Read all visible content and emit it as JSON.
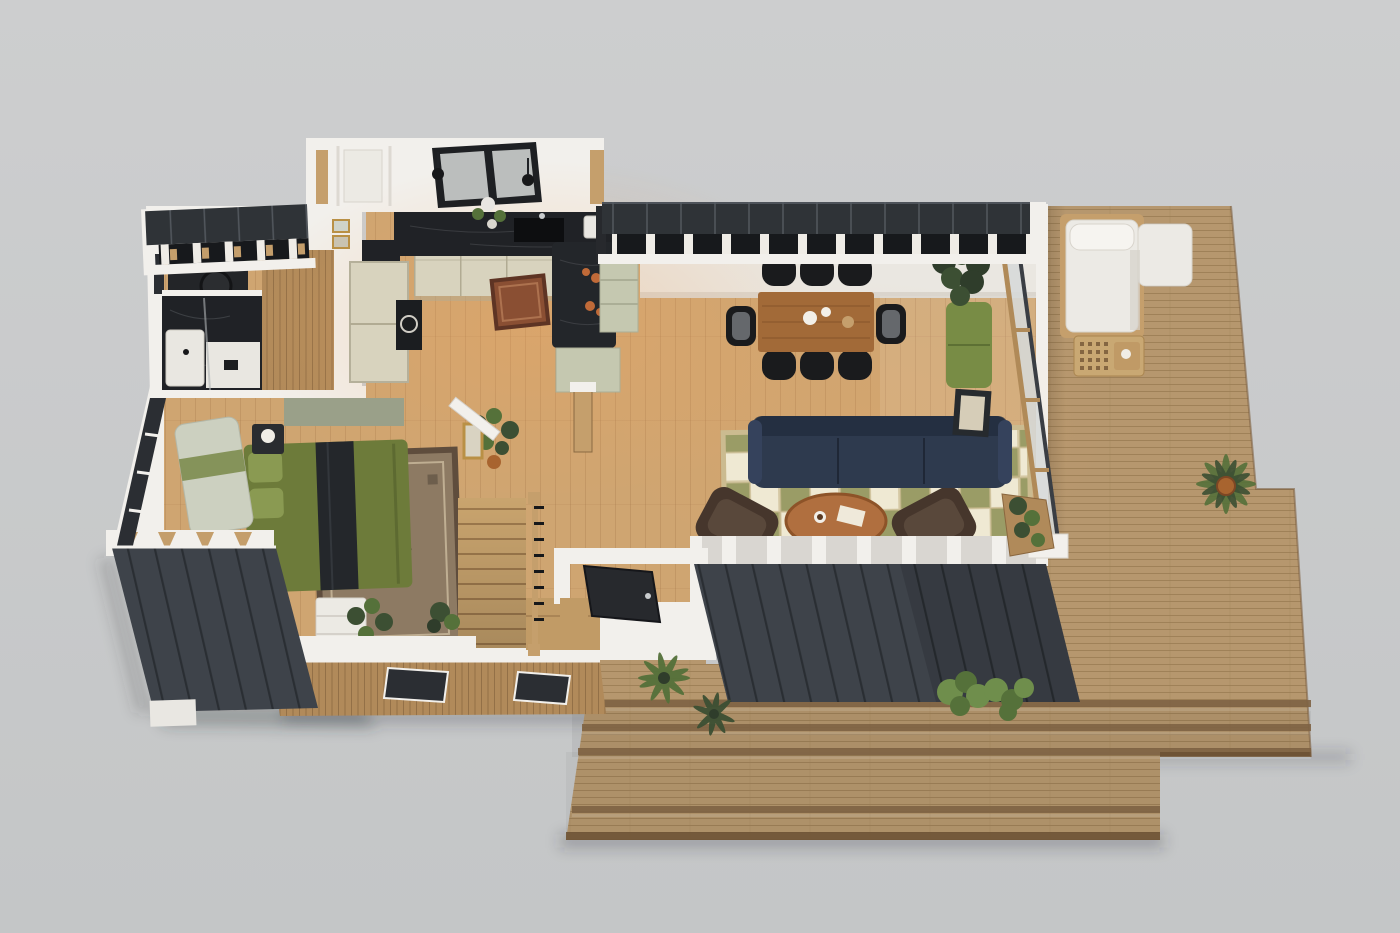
{
  "colors": {
    "background": "#cdcecf",
    "background_bottom": "#c4c6c7",
    "wall_white": "#f2f0ec",
    "wall_face": "#eae7e1",
    "wall_shade": "#cfc9c0",
    "roof_black": "#2f3337",
    "roof_seam": "#565c63",
    "rafter_dark": "#17191c",
    "joist_white": "#efece6",
    "rafter_wood": "#c49e6b",
    "panel_dark": "#3e434a",
    "panel_seam": "#272b30",
    "deck_wood": "#b6976e",
    "deck_line": "#9b7c54",
    "step_face": "#7e6344",
    "step_edge": "#6e5336",
    "floor_wood": "#cfa571",
    "floor_line": "#8a5f36",
    "floor_glow": "#f2a45e",
    "slat_wood": "#b18a5a",
    "slat_line": "#8a673f",
    "marble_dark": "#202226",
    "marble_vein": "#585c60",
    "cabinet_cream": "#d8d3be",
    "cabinet_line": "#b1ab93",
    "cabinet_sage": "#c5c8b0",
    "island_dark": "#23262a",
    "stair_wood": "#c9a46e",
    "stair_line": "#8f6b42",
    "rug_red": "#8a4f33",
    "rug_red_border": "#5e3424",
    "rug_checker_olive": "#9a9c66",
    "rug_checker_cream": "#efe9d3",
    "rug_checker_line": "#cbbb90",
    "sofa_navy": "#2e3a4e",
    "sofa_navy_dark": "#222d3f",
    "armchair_brown": "#46362c",
    "armchair_light": "#5d4b3e",
    "table_wood": "#a26a38",
    "table_wood_dark": "#7c4e26",
    "coffee_table": "#b06f3f",
    "chair_black": "#1a1b1d",
    "chair_pad": "#65686c",
    "sofa_green": "#788c45",
    "bed_green": "#6d7b3a",
    "bed_green_light": "#8a9a52",
    "throw_dark": "#24272b",
    "bench_light": "#ccd0c0",
    "throw_green": "#7d8c4f",
    "rug_bed_field": "#8d7a63",
    "rug_bed_border": "#5f4d3d",
    "rug_bed_motif": "#4e4136",
    "rug_bed_line": "#bfae92",
    "daybed_white": "#eceae5",
    "daybed_shadow": "#d6d2ca",
    "frame_tan": "#c59f6c",
    "lattice": "#c9a873",
    "lattice_hole": "#7d5f3d",
    "plant_deep": "#2f3d2b",
    "plant_dark": "#3c4f33",
    "plant_mid": "#55713a",
    "plant_light": "#6f8e4c",
    "pot_terracotta": "#a8642f",
    "glass_light": "#d6d9d8",
    "glass_frame": "#b08a58",
    "track_dark": "#3a3e44",
    "door_dark": "#27292d",
    "window_dark": "#2b2e33",
    "mirror_frame": "#262a2e",
    "mirror_glass": "#d6cdb8",
    "art_frame": "#b99045",
    "art_scene": "#9aa089",
    "dresser_white": "#eceae4",
    "lamp_white": "#f0ede6"
  },
  "scene": {
    "type": "3d-floor-plan-render",
    "view": "cutaway-top-down-isometric",
    "areas": [
      {
        "name": "entry-office",
        "objects": [
          "desk",
          "desk-chair",
          "potted-plant"
        ]
      },
      {
        "name": "bathroom",
        "objects": [
          "marble-shower",
          "shower-tray",
          "glass-divider",
          "vanity"
        ]
      },
      {
        "name": "hallway-closet",
        "objects": [
          "framed-art",
          "framed-art"
        ]
      },
      {
        "name": "kitchen",
        "objects": [
          "marble-counter",
          "cream-cabinets",
          "tall-pantry-cabinets",
          "range-oven",
          "kitchen-island",
          "sink",
          "window",
          "pendant-lights",
          "runner-rug",
          "toaster",
          "flower-vase",
          "fruit-bowls",
          "island-plant",
          "sage-cabinet"
        ]
      },
      {
        "name": "dining-area",
        "objects": [
          "wood-dining-table",
          "black-dining-chairs-x8",
          "tableware"
        ]
      },
      {
        "name": "living-area",
        "objects": [
          "navy-sofa",
          "checkered-rug",
          "oval-coffee-table",
          "leather-armchair-left",
          "leather-armchair-right",
          "green-bench",
          "tall-plant",
          "leaning-mirror",
          "monstera-plant",
          "small-frame",
          "glass-sliding-wall",
          "planter-box"
        ]
      },
      {
        "name": "bedroom",
        "objects": [
          "green-bed",
          "vintage-rug",
          "window-bench",
          "nightstand",
          "table-lamp",
          "wall-art",
          "white-dresser",
          "fiddle-leaf-plant",
          "open-door",
          "floor-windows"
        ]
      },
      {
        "name": "staircase",
        "objects": [
          "wood-stairs",
          "railing",
          "landing",
          "wood-post"
        ]
      },
      {
        "name": "entry-porch",
        "objects": [
          "front-door",
          "slatted-wood-wall",
          "porch-windows",
          "porch-deck"
        ]
      },
      {
        "name": "deck",
        "objects": [
          "outdoor-daybed",
          "lattice-side-table",
          "potted-palm",
          "deck-steps",
          "shrubs",
          "ferns"
        ]
      },
      {
        "name": "exterior",
        "objects": [
          "standing-seam-roof-entry",
          "standing-seam-roof-main",
          "dark-panel-wall-left",
          "dark-panel-wall-front",
          "foundation-block"
        ]
      }
    ]
  }
}
